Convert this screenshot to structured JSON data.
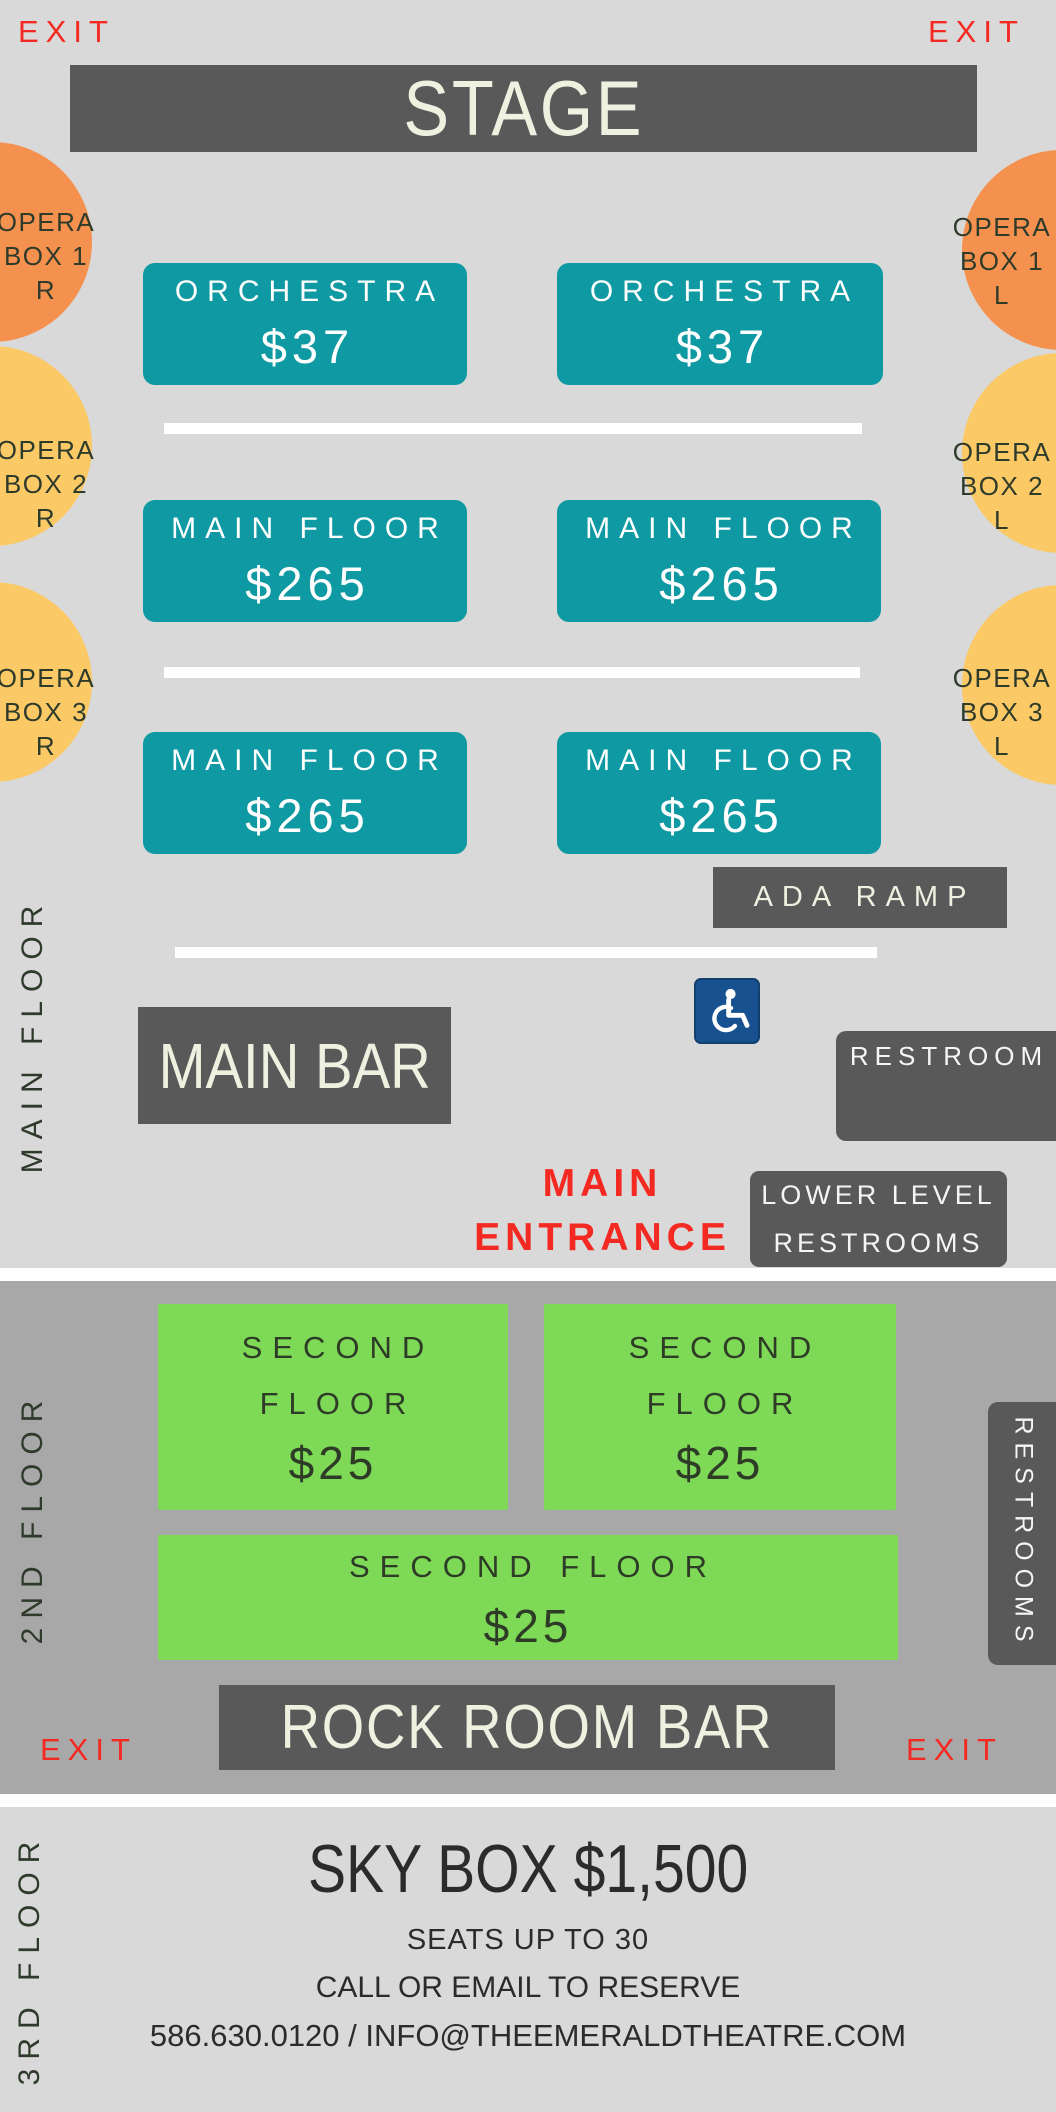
{
  "palette": {
    "bg_light": "#d9d9d9",
    "bg_mid": "#a8a8a8",
    "dark_box": "#595959",
    "teal": "#0f99a2",
    "green": "#7ed957",
    "orange": "#f5914f",
    "yellow": "#fbc966",
    "red": "#f42a22",
    "blue": "#17518f",
    "cream": "#eff1e0",
    "dark_text": "#2e3a2a"
  },
  "icons": {
    "wheelchair": "♿"
  },
  "exits": {
    "top_left": "EXIT",
    "top_right": "EXIT"
  },
  "stage": {
    "label": "STAGE"
  },
  "opera_boxes": [
    {
      "line1": "OPERA",
      "line2": "BOX 1",
      "line3": "R"
    },
    {
      "line1": "OPERA",
      "line2": "BOX 2",
      "line3": "R"
    },
    {
      "line1": "OPERA",
      "line2": "BOX 3",
      "line3": "R"
    },
    {
      "line1": "OPERA",
      "line2": "BOX 1",
      "line3": "L"
    },
    {
      "line1": "OPERA",
      "line2": "BOX 2",
      "line3": "L"
    },
    {
      "line1": "OPERA",
      "line2": "BOX 3",
      "line3": "L"
    }
  ],
  "main_floor": {
    "vertical_label": "MAIN FLOOR",
    "orchestra_left": {
      "label": "ORCHESTRA",
      "price": "$37"
    },
    "orchestra_right": {
      "label": "ORCHESTRA",
      "price": "$37"
    },
    "row1_left": {
      "label": "MAIN FLOOR",
      "price": "$265"
    },
    "row1_right": {
      "label": "MAIN FLOOR",
      "price": "$265"
    },
    "row2_left": {
      "label": "MAIN FLOOR",
      "price": "$265"
    },
    "row2_right": {
      "label": "MAIN FLOOR",
      "price": "$265"
    },
    "ada_ramp_label": "ADA RAMP",
    "main_bar_label": "MAIN BAR",
    "restroom_label": "RESTROOM",
    "main_entrance": {
      "line1": "MAIN",
      "line2": "ENTRANCE"
    },
    "lower_level_restrooms": {
      "line1": "LOWER LEVEL",
      "line2": "RESTROOMS"
    }
  },
  "second_floor": {
    "vertical_label": "2ND FLOOR",
    "box_left": {
      "line1": "SECOND",
      "line2": "FLOOR",
      "price": "$25"
    },
    "box_right": {
      "line1": "SECOND",
      "line2": "FLOOR",
      "price": "$25"
    },
    "box_wide": {
      "label": "SECOND FLOOR",
      "price": "$25"
    },
    "restrooms_label": "RESTROOMS",
    "rock_room_bar_label": "ROCK ROOM BAR",
    "exit_left": "EXIT",
    "exit_right": "EXIT"
  },
  "third_floor": {
    "vertical_label": "3RD FLOOR",
    "title": "SKY BOX $1,500",
    "seats": "SEATS UP TO 30",
    "reserve": "CALL OR EMAIL TO RESERVE",
    "contact": "586.630.0120 / INFO@THEEMERALDTHEATRE.COM"
  }
}
